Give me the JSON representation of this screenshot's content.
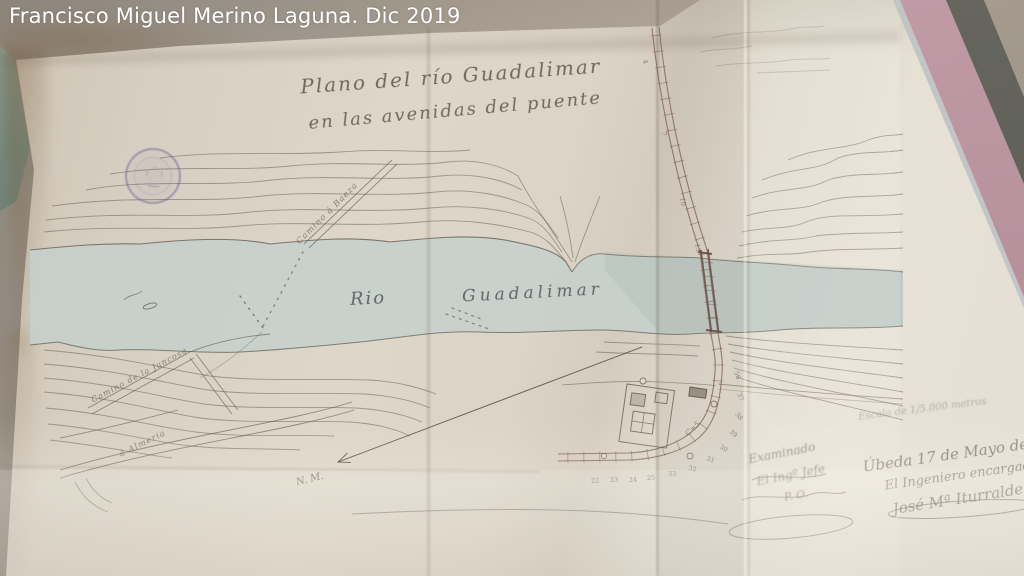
{
  "photo_caption": "Francisco Miguel Merino Laguna. Dic 2019",
  "map": {
    "title_line1": "Plano del río Guadalimar",
    "title_line2": "en las avenidas del puente",
    "river_name_part1": "Rio",
    "river_name_part2": "Guadalimar",
    "labels": {
      "camino_baeza": "Camino á Baeza",
      "camino_juncosa": "Camino de la Juncosa",
      "camino_almeria": "á Almería",
      "north_mark": "N. M.",
      "curve_note": "C=5"
    },
    "stations": [
      {
        "label": "4",
        "x": 643,
        "y": 60,
        "rot": 80
      },
      {
        "label": "7",
        "x": 662,
        "y": 132,
        "rot": 80
      },
      {
        "label": "10",
        "x": 680,
        "y": 198,
        "rot": 80
      },
      {
        "label": "13",
        "x": 695,
        "y": 244,
        "rot": 80
      },
      {
        "label": "56",
        "x": 734,
        "y": 372,
        "rot": 70
      },
      {
        "label": "37",
        "x": 737,
        "y": 394,
        "rot": 65
      },
      {
        "label": "38",
        "x": 735,
        "y": 414,
        "rot": 55
      },
      {
        "label": "39",
        "x": 729,
        "y": 432,
        "rot": 45
      },
      {
        "label": "30",
        "x": 719,
        "y": 448,
        "rot": 30
      },
      {
        "label": "31",
        "x": 706,
        "y": 460,
        "rot": 20
      },
      {
        "label": "32",
        "x": 688,
        "y": 470,
        "rot": 10
      },
      {
        "label": "33",
        "x": 668,
        "y": 476,
        "rot": 0
      },
      {
        "label": "25",
        "x": 647,
        "y": 480,
        "rot": -4
      },
      {
        "label": "24",
        "x": 629,
        "y": 482,
        "rot": -4
      },
      {
        "label": "23",
        "x": 610,
        "y": 482,
        "rot": -4
      },
      {
        "label": "22",
        "x": 591,
        "y": 483,
        "rot": -4
      }
    ],
    "annotations": {
      "scale_note": "Escala de 1/5.000 metros",
      "review_line1": "Examinado",
      "review_line2": "El Ingº Jefe",
      "review_line3": "P. O.",
      "date_place": "Úbeda 17 de Mayo de 18..",
      "engineer_title": "El Ingeniero encargado",
      "engineer_name": "José Mª Iturralde"
    },
    "colors": {
      "paper": "#ded6c9",
      "river": "#c3cfcc",
      "ink": "#6b6157",
      "road_ink": "#7a5a4e",
      "stamp": "#6e68a4",
      "mat_pink": "#bb96a0",
      "frame_dark": "#5e5e58"
    }
  }
}
